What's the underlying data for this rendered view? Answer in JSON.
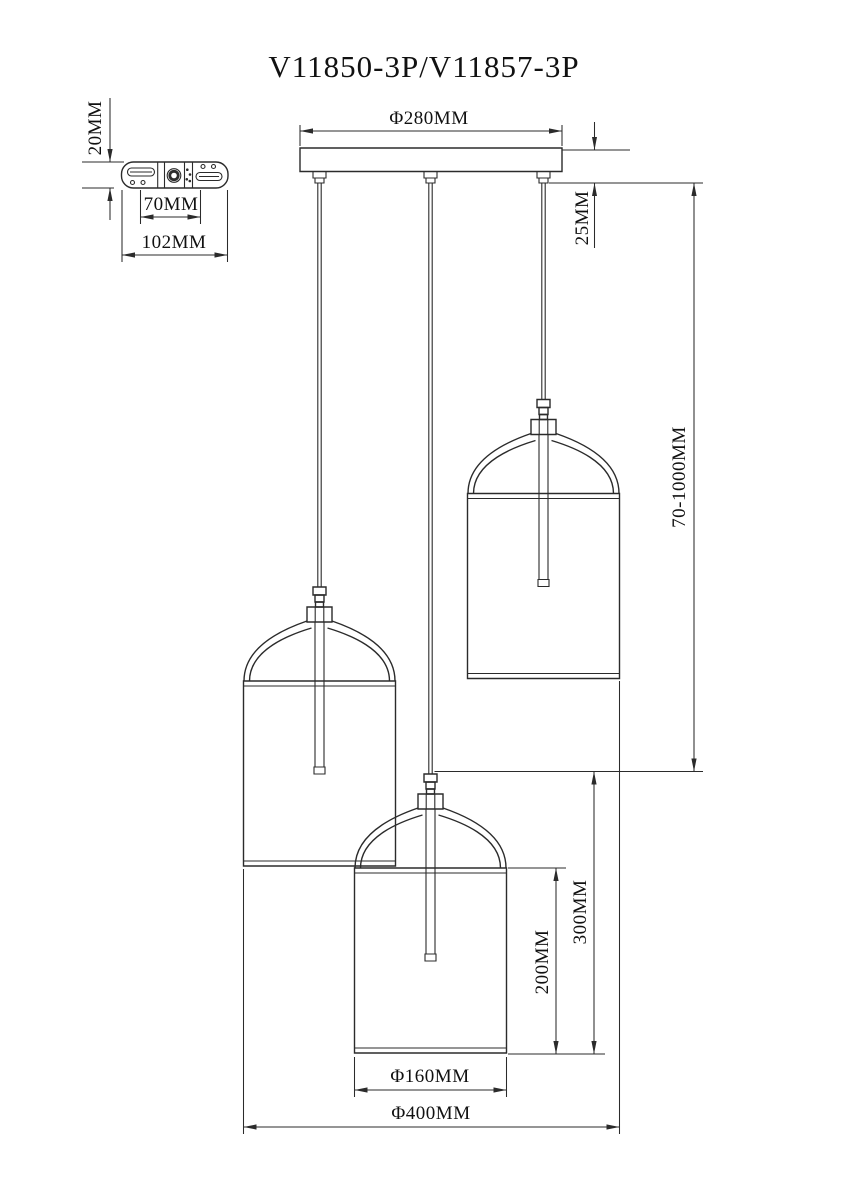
{
  "title": "V11850-3P/V11857-3P",
  "labels": {
    "bracket_height": "20MM",
    "bracket_hole_spacing": "70MM",
    "bracket_width": "102MM",
    "canopy_diameter": "Φ280MM",
    "canopy_height": "25MM",
    "suspension_range": "70-1000MM",
    "shade_stagger": "300MM",
    "shade_height": "200MM",
    "shade_diameter": "Φ160MM",
    "fixture_diameter": "Φ400MM"
  },
  "colors": {
    "line": "#2b2b2b",
    "background": "#ffffff",
    "text": "#111111"
  }
}
